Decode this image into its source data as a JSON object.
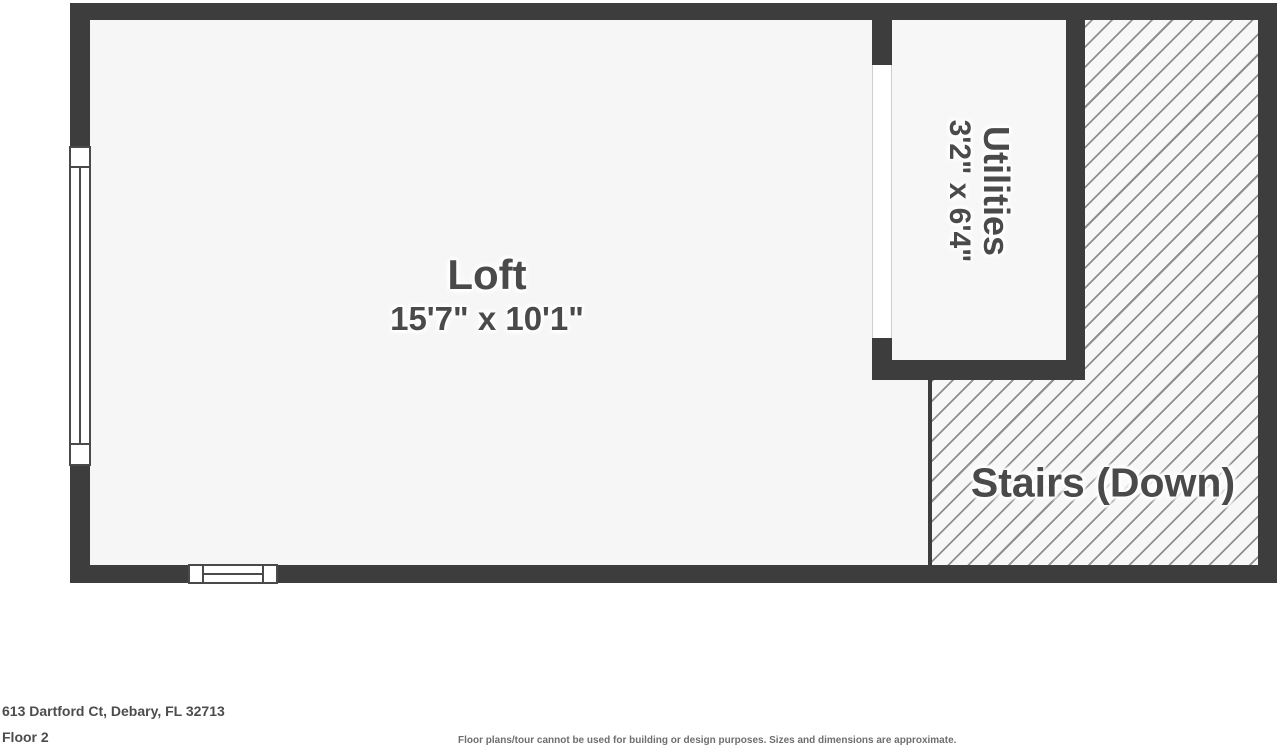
{
  "plan": {
    "rooms": {
      "loft": {
        "name": "Loft",
        "dimensions": "15'7\" x 10'1\""
      },
      "utilities": {
        "name": "Utilities",
        "dimensions": "3'2\" x 6'4\""
      },
      "stairs": {
        "label": "Stairs (Down)"
      }
    },
    "colors": {
      "wall": "#3d3d3d",
      "floor": "#f6f6f6",
      "hatch_line": "#8f8f8f",
      "label_text": "#4a4a4a",
      "background": "#ffffff"
    }
  },
  "footer": {
    "address": "613 Dartford Ct, Debary, FL 32713",
    "floor_label": "Floor 2",
    "disclaimer": "Floor plans/tour cannot be used for building or design purposes. Sizes and dimensions are approximate."
  }
}
